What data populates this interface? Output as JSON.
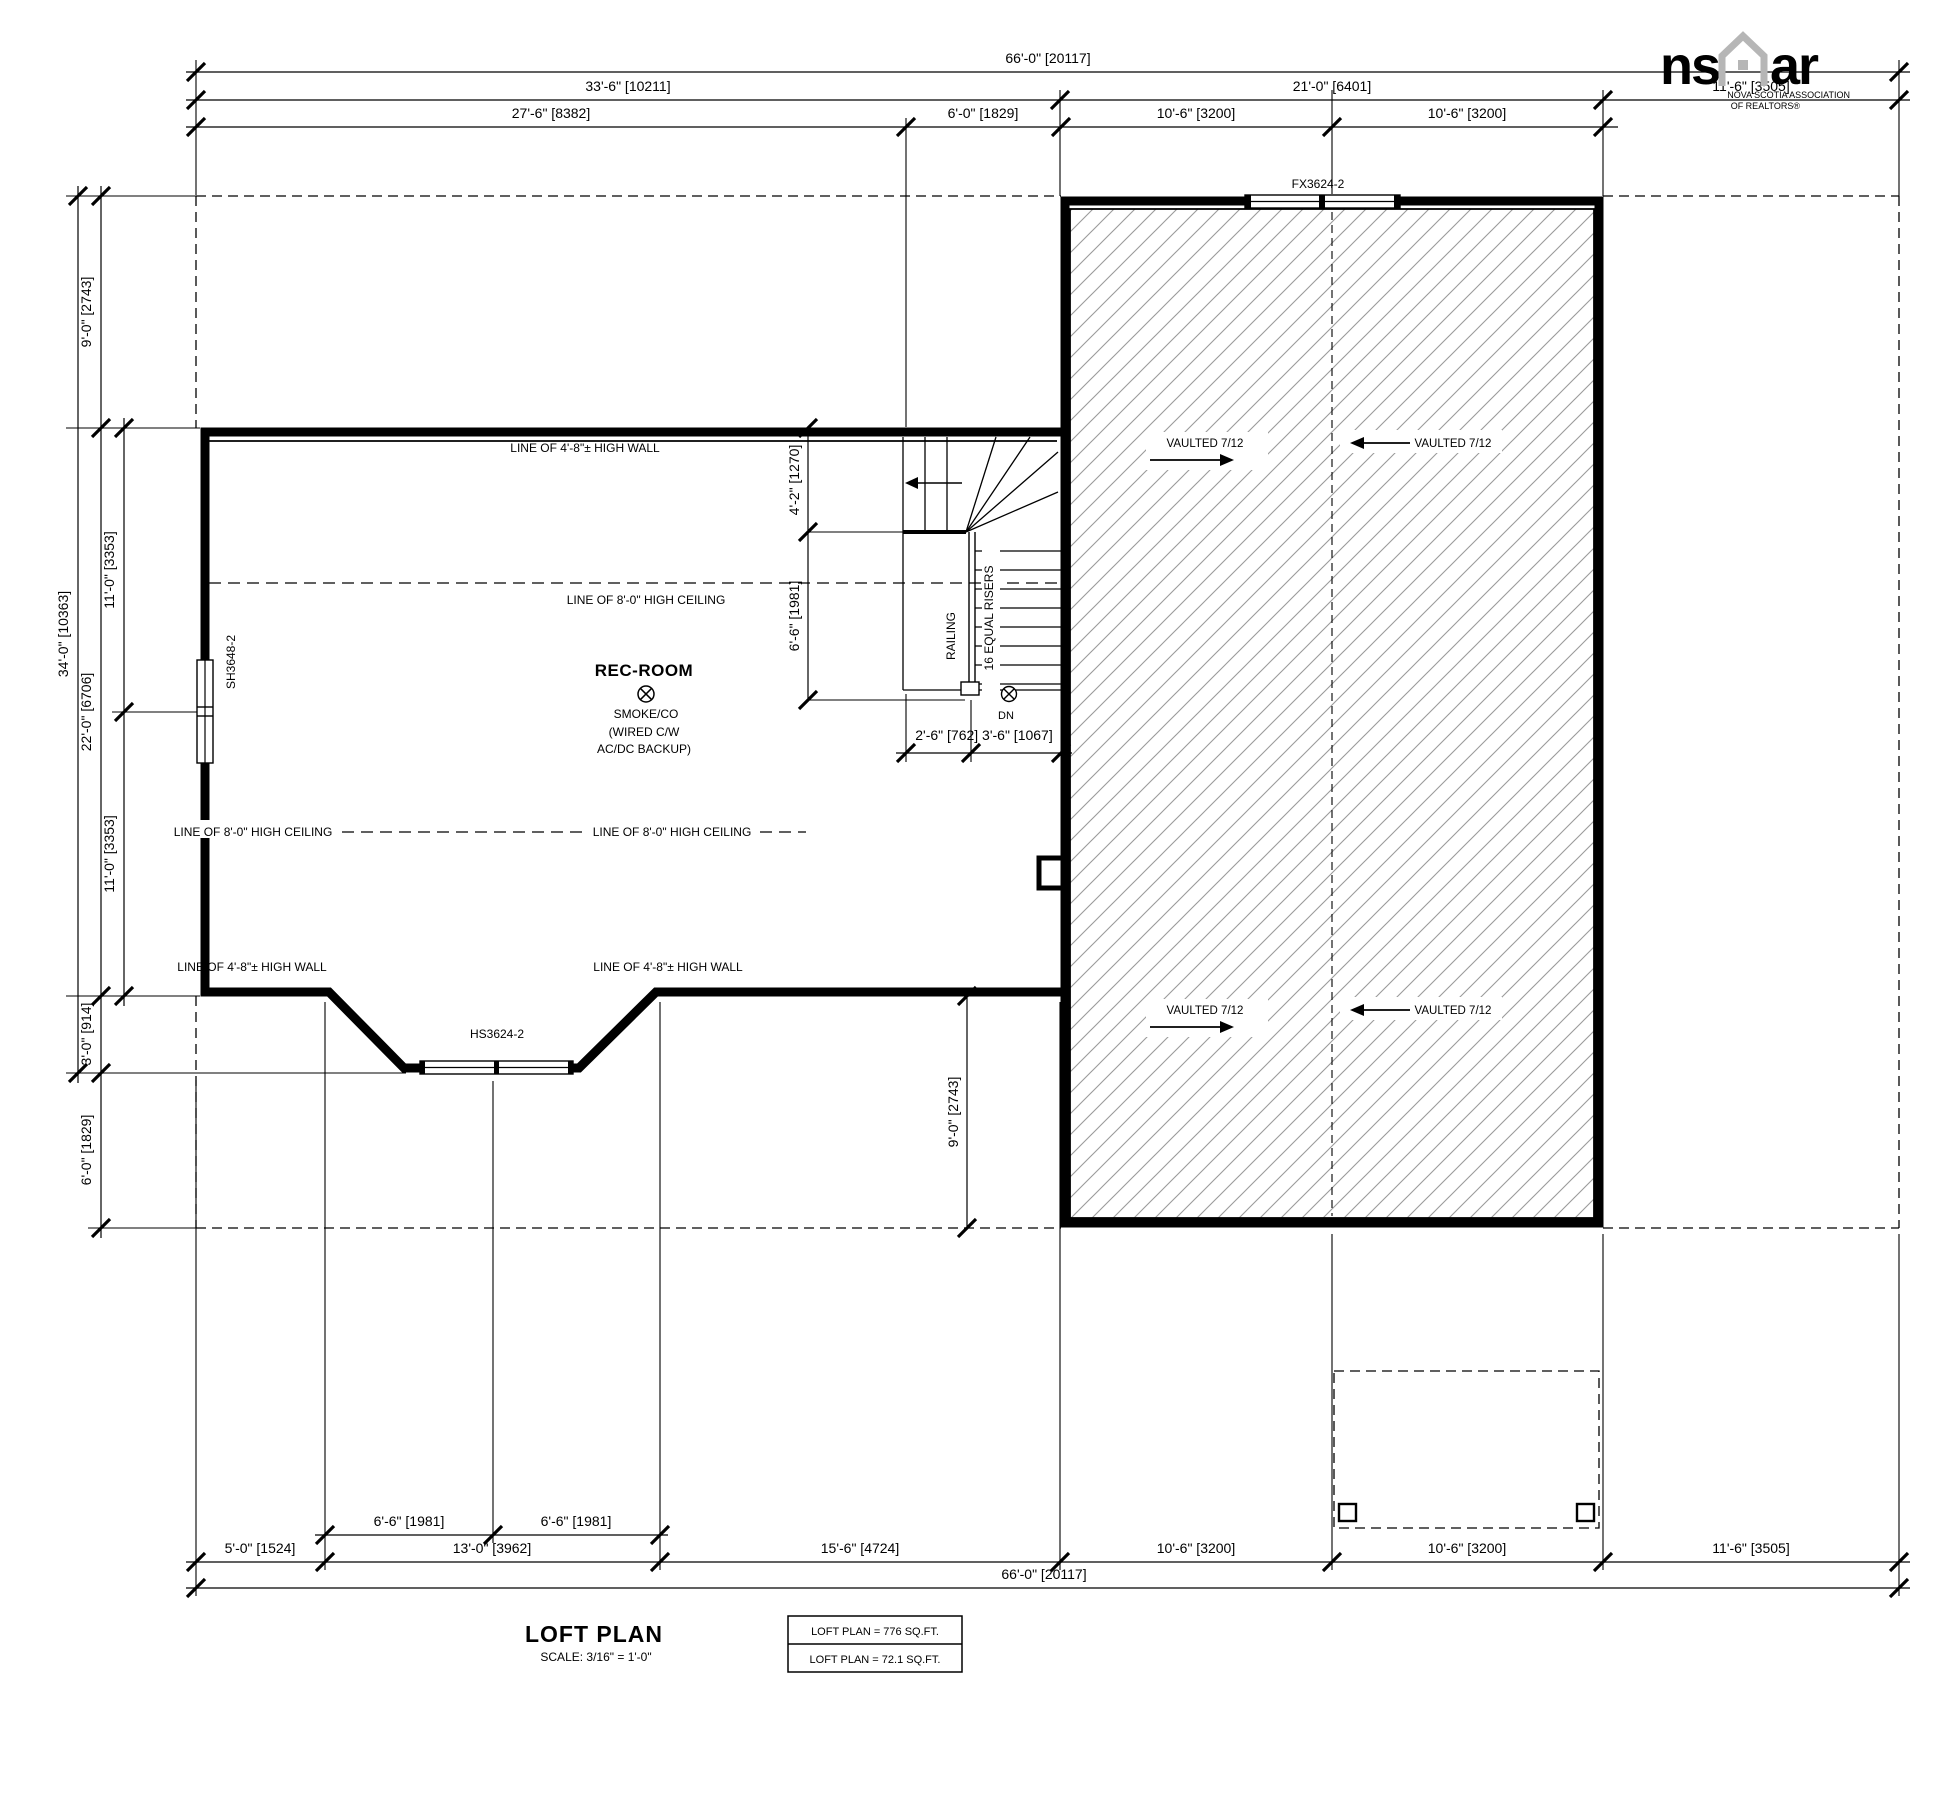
{
  "page": {
    "background": "#ffffff",
    "line_color": "#000000",
    "hatch_color": "#9a9a9a",
    "logo_color": "#b6b6b6"
  },
  "logo": {
    "left": "ns",
    "right": "ar",
    "caption1": "NOVA SCOTIA ASSOCIATION",
    "caption2": "OF REALTORS®"
  },
  "dims_top": {
    "overall": "66'-0\" [20117]",
    "r2": [
      "33'-6\" [10211]",
      "21'-0\" [6401]",
      "11'-6\" [3505]"
    ],
    "r3": [
      "27'-6\" [8382]",
      "6'-0\" [1829]",
      "10'-6\" [3200]",
      "10'-6\" [3200]"
    ]
  },
  "dims_left": {
    "total": "34'-0\" [10363]",
    "seg": [
      "9'-0\" [2743]",
      "22'-0\" [6706]",
      "3'-0\" [914]",
      "6'-0\" [1829]"
    ],
    "inner": [
      "11'-0\" [3353]",
      "11'-0\" [3353]"
    ]
  },
  "dims_bottom": {
    "r1": [
      "6'-6\" [1981]",
      "6'-6\" [1981]"
    ],
    "r2": [
      "5'-0\" [1524]",
      "13'-0\" [3962]",
      "15'-6\" [4724]",
      "10'-6\" [3200]",
      "10'-6\" [3200]",
      "11'-6\" [3505]"
    ],
    "overall": "66'-0\" [20117]",
    "roof_depth": "9'-0\" [2743]"
  },
  "dims_stair": {
    "winder": "4'-2\" [1270]",
    "run": "6'-6\" [1981]",
    "widths": "2'-6\" [762] 3'-6\" [1067]"
  },
  "windows": {
    "fixed": "FX3624-2",
    "single_hung": "SH3648-2",
    "horizontal_slider": "HS3624-2"
  },
  "room": {
    "name": "REC-ROOM",
    "smoke_line1": "SMOKE/CO",
    "smoke_line2": "(WIRED C/W",
    "smoke_line3": "AC/DC BACKUP)"
  },
  "stairs": {
    "railing": "RAILING",
    "risers": "16 EQUAL RISERS",
    "down": "DN"
  },
  "reference_lines": {
    "high_wall_top": "LINE OF 4'-8\"± HIGH WALL",
    "ceiling_upper": "LINE OF 8'-0\" HIGH CEILING",
    "ceiling_lower_left": "LINE OF 8'-0\" HIGH CEILING",
    "ceiling_lower_right": "LINE OF 8'-0\" HIGH CEILING",
    "high_wall_lower_left": "LINE OF 4'-8\"± HIGH WALL",
    "high_wall_lower_right": "LINE OF 4'-8\"± HIGH WALL"
  },
  "vaulted": {
    "labels": [
      "VAULTED 7/12",
      "VAULTED 7/12",
      "VAULTED 7/12",
      "VAULTED 7/12"
    ]
  },
  "title_block": {
    "title": "LOFT PLAN",
    "scale": "SCALE: 3/16\" = 1'-0\"",
    "area_row1": "LOFT PLAN = 776 SQ.FT.",
    "area_row2": "LOFT PLAN = 72.1 SQ.FT."
  }
}
